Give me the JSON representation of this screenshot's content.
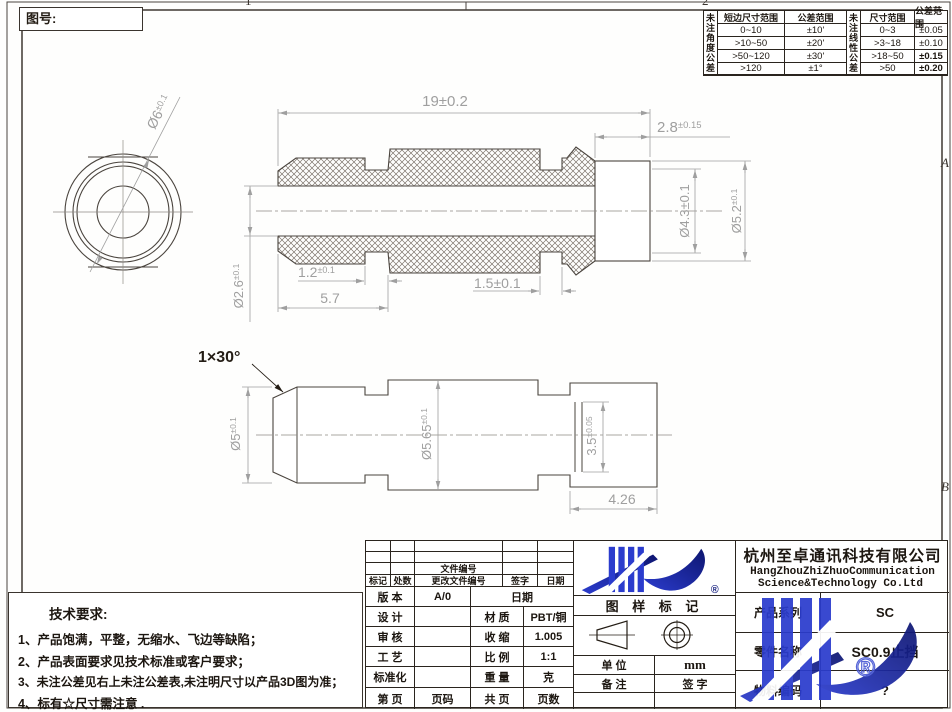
{
  "sheet": {
    "drawing_no_label": "图号:",
    "zones": {
      "a": "A",
      "b": "B",
      "one": "1",
      "two": "2"
    }
  },
  "tol_table": {
    "angle": {
      "side_header": "未注角度公差",
      "col1": "短边尺寸范围",
      "col2": "公差范围",
      "rows": [
        [
          "0~10",
          "±10'"
        ],
        [
          ">10~50",
          "±20'"
        ],
        [
          ">50~120",
          "±30'"
        ],
        [
          ">120",
          "±1°"
        ]
      ]
    },
    "linear": {
      "side_header": "未注线性公差",
      "col1": "尺寸范围",
      "col2": "公差范围",
      "rows": [
        [
          "0~3",
          "±0.05"
        ],
        [
          ">3~18",
          "±0.10"
        ],
        [
          ">18~50",
          "±0.15"
        ],
        [
          ">50",
          "±0.20"
        ]
      ]
    }
  },
  "dims": {
    "total_len": {
      "v": "19",
      "t": "±0.2"
    },
    "cap_len": {
      "v": "2.8",
      "t": "±0.15"
    },
    "groove1": {
      "v": "1.2",
      "t": "±0.1"
    },
    "nose_len": "5.7",
    "groove2": {
      "v": "1.5",
      "t": "±0.1"
    },
    "cap_bore": {
      "v": "Ø4.3",
      "t": "±0.1"
    },
    "cap_od": {
      "v": "Ø5.2",
      "t": "±0.1"
    },
    "bore": {
      "v": "Ø2.6",
      "t": "±0.1"
    },
    "end_od": {
      "v": "Ø6",
      "t": "±0.1"
    },
    "chamfer": "1×30°",
    "nose_od": {
      "v": "Ø5",
      "t": "±0.1"
    },
    "body_od": {
      "v": "Ø5.65",
      "t": "±0.1"
    },
    "ring_od": {
      "v": "3.5",
      "t": "±0.05"
    },
    "tail_len": "4.26"
  },
  "tech_req": {
    "title": "技术要求:",
    "items": [
      "1、产品饱满，平整，无缩水、飞边等缺陷；",
      "2、产品表面要求见技术标准或客户要求；",
      "3、未注公差见右上未注公差表,未注明尺寸以产品3D图为准；",
      "4、标有☆尺寸需注意 ."
    ]
  },
  "title_block": {
    "doc_no_label": "文件编号",
    "rev_header": [
      "标记",
      "处数",
      "更改文件编号",
      "签字",
      "日期"
    ],
    "version_label": "版 本",
    "version": "A/0",
    "date_label": "日期",
    "design_label": "设 计",
    "material_label": "材 质",
    "material": "PBT/铜",
    "check_label": "审 核",
    "shrink_label": "收 缩",
    "shrink": "1.005",
    "process_label": "工 艺",
    "scale_label": "比 例",
    "scale": "1:1",
    "std_label": "标准化",
    "weight_label": "重 量",
    "weight": "克",
    "page_label": "第 页",
    "page_no": "页码",
    "total_label": "共 页",
    "total_pages": "页数",
    "stamp_label": "图 样 标 记",
    "unit_label": "单 位",
    "unit": "mm",
    "remark_label": "备 注",
    "sign_label": "签 字",
    "company_cn": "杭州至卓通讯科技有限公司",
    "company_en1": "HangZhouZhiZhuoCommunication",
    "company_en2": "Science&Technology Co.Ltd",
    "series_label": "产品系列",
    "series": "SC",
    "part_label": "零件名称",
    "part": "SC0.9止挡",
    "code_label": "物料编码",
    "code": "?",
    "registered": "®"
  },
  "colors": {
    "line": "#4a443e",
    "dim_text": "#9f9f9f",
    "logo_blue": "#2b3ccd",
    "logo_navy": "#0d1570"
  }
}
